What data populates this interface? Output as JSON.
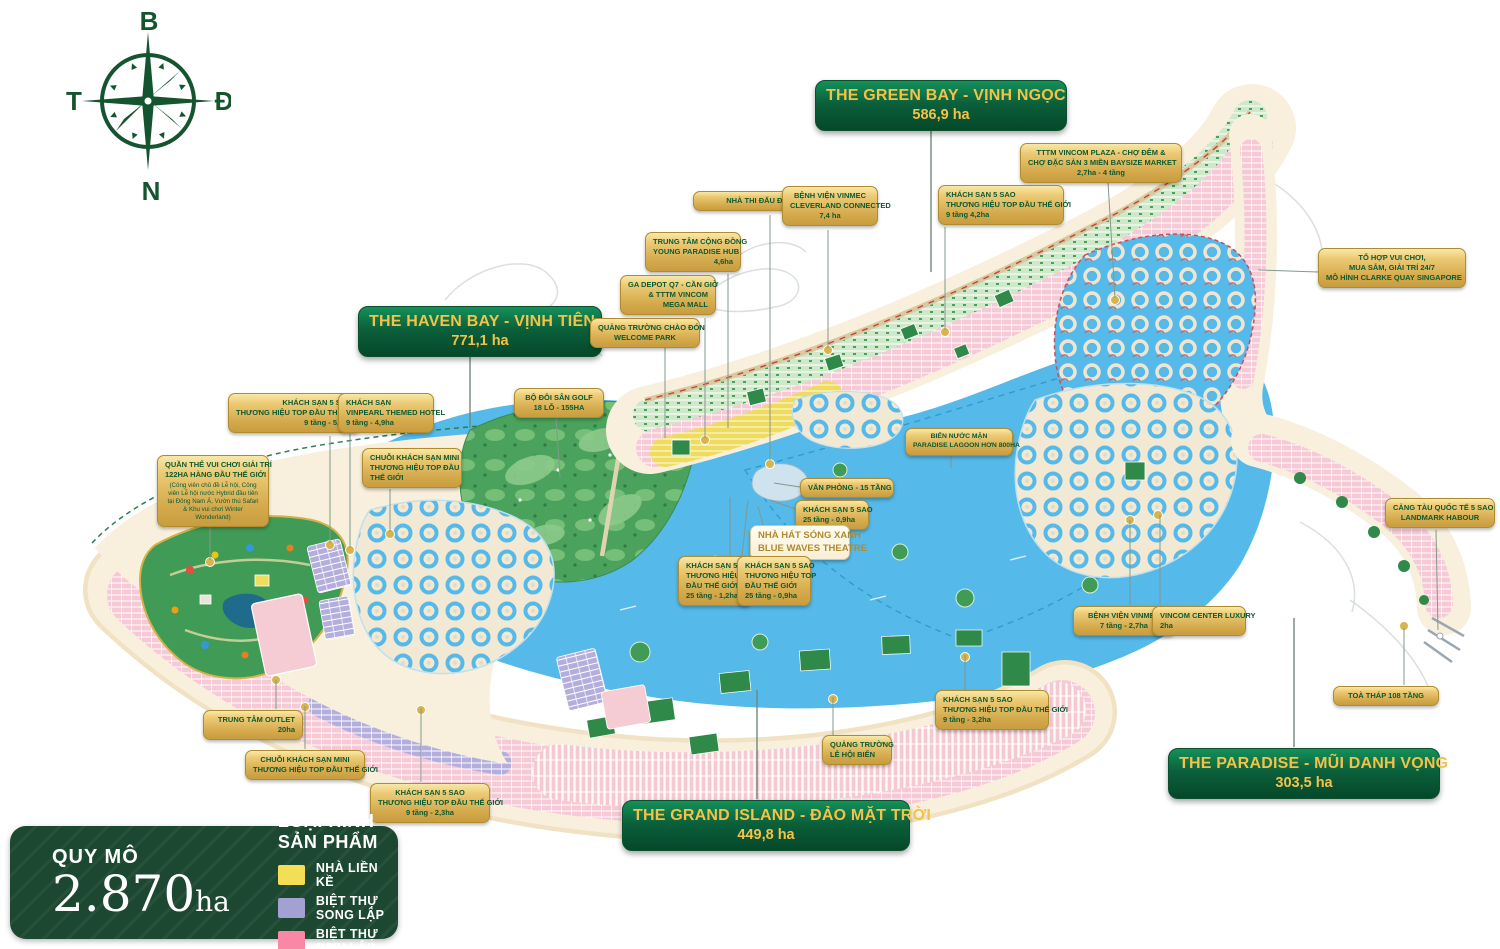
{
  "compass": {
    "north": "B",
    "east": "Đ",
    "south": "N",
    "west": "T",
    "color": "#14542f"
  },
  "zones": [
    {
      "id": "green-bay",
      "title": "THE GREEN BAY - VỊNH NGỌC",
      "area": "586,9 ha",
      "x": 815,
      "y": 80,
      "w": 230,
      "leader": [
        931,
        130,
        931,
        272
      ]
    },
    {
      "id": "haven-bay",
      "title": "THE HAVEN BAY - VỊNH TIÊN",
      "area": "771,1 ha",
      "x": 358,
      "y": 306,
      "w": 222,
      "leader": [
        470,
        355,
        470,
        428
      ]
    },
    {
      "id": "grand-island",
      "title": "THE GRAND ISLAND - ĐẢO MẶT TRỜI",
      "area": "449,8 ha",
      "x": 622,
      "y": 800,
      "w": 266,
      "leader": [
        757,
        799,
        757,
        690
      ]
    },
    {
      "id": "paradise",
      "title": "THE PARADISE - MŨI DANH VỌNG",
      "area": "303,5 ha",
      "x": 1168,
      "y": 748,
      "w": 250,
      "leader": [
        1294,
        747,
        1294,
        618
      ]
    }
  ],
  "callouts": [
    {
      "id": "tttm-vincom-plaza",
      "x": 1020,
      "y": 143,
      "w": 162,
      "align": "center",
      "lines": [
        "TTTM VINCOM PLAZA - CHỢ ĐÊM &",
        "CHỢ ĐẶC SẢN 3 MIỀN BAYSIZE MARKET",
        "2,7ha - 4 tầng"
      ],
      "leader": [
        1108,
        182,
        1115,
        298
      ]
    },
    {
      "id": "khach-san-4-2ha",
      "x": 938,
      "y": 185,
      "w": 126,
      "align": "left",
      "lines": [
        "KHÁCH SẠN 5 SAO",
        "THƯƠNG HIỆU TOP ĐẦU THẾ GIỚI",
        "9 tầng 4,2ha"
      ],
      "leader": [
        945,
        227,
        945,
        330
      ]
    },
    {
      "id": "nha-thi-dau",
      "x": 693,
      "y": 191,
      "w": 152,
      "align": "center",
      "lines": [
        "NHÀ THI ĐẤU ĐA NĂNG"
      ],
      "leader": [
        770,
        215,
        770,
        460
      ]
    },
    {
      "id": "benh-vien-cleverland",
      "x": 782,
      "y": 186,
      "w": 96,
      "align": "center",
      "lines": [
        "BỆNH VIỆN VINMEC",
        "CLEVERLAND CONNECTED",
        "7,4 ha"
      ],
      "leader": [
        828,
        230,
        828,
        348
      ]
    },
    {
      "id": "trung-tam-cong-dong",
      "x": 645,
      "y": 232,
      "w": 96,
      "align": "right",
      "lines": [
        "TRUNG TÂM CỘNG ĐỒNG",
        "YOUNG PARADISE HUB",
        "4,6ha"
      ],
      "leader": [
        728,
        274,
        728,
        428
      ]
    },
    {
      "id": "ga-depot",
      "x": 620,
      "y": 275,
      "w": 96,
      "align": "right",
      "lines": [
        "GA DEPOT Q7 - CẦN GIỜ",
        "& TTTM VINCOM",
        "MEGA MALL"
      ],
      "leader": [
        705,
        318,
        705,
        438
      ]
    },
    {
      "id": "quang-truong-chao-don",
      "x": 590,
      "y": 318,
      "w": 110,
      "align": "center",
      "lines": [
        "QUẢNG TRƯỜNG CHÀO ĐÓN",
        "WELCOME PARK"
      ],
      "leader": [
        665,
        348,
        665,
        438
      ]
    },
    {
      "id": "to-hop-vui-choi",
      "x": 1318,
      "y": 248,
      "w": 148,
      "align": "center",
      "lines": [
        "TỔ HỢP VUI CHƠI,",
        "MUA SẮM, GIẢI TRÍ 24/7",
        "MÔ HÌNH CLARKE QUAY SINGAPORE"
      ],
      "leader": [
        1318,
        272,
        1258,
        270
      ]
    },
    {
      "id": "khach-san-5-2ha",
      "x": 228,
      "y": 393,
      "w": 132,
      "align": "right",
      "lines": [
        "KHÁCH SẠN 5 SAO",
        "THƯƠNG HIỆU TOP ĐẦU THẾ GIỚI",
        "9 tầng - 5,2ha"
      ],
      "leader": [
        330,
        436,
        330,
        543
      ]
    },
    {
      "id": "vinpearl-hotel",
      "x": 338,
      "y": 393,
      "w": 96,
      "align": "left",
      "lines": [
        "KHÁCH SẠN",
        "VINPEARL THEMED HOTEL",
        "9 tầng - 4,9ha"
      ],
      "leader": [
        350,
        434,
        350,
        548
      ]
    },
    {
      "id": "bo-doi-san-golf",
      "x": 514,
      "y": 388,
      "w": 90,
      "align": "center",
      "lines": [
        "BỘ ĐÔI SÂN GOLF",
        "18 LỖ - 155HA"
      ],
      "leader": [
        556,
        418,
        560,
        478
      ]
    },
    {
      "id": "chuoi-khach-san-mini-1",
      "x": 362,
      "y": 448,
      "w": 100,
      "align": "left",
      "lines": [
        "CHUỖI KHÁCH SẠN MINI",
        "THƯƠNG HIỆU TOP ĐẦU",
        "THẾ GIỚI"
      ],
      "leader": [
        390,
        489,
        390,
        532
      ]
    },
    {
      "id": "quan-the-vui-choi",
      "x": 157,
      "y": 455,
      "w": 112,
      "align": "center",
      "lines": [
        "QUẦN THỂ VUI CHƠI GIẢI TRÍ",
        "122HA HÀNG ĐẦU  THẾ GIỚI"
      ],
      "small": "(Công viên chủ đề Lễ hội, Công viên Lễ hội nước Hybrid đầu tiên tại Đông Nam Á, Vườn thú Safari & Khu vui chơi Winter Wonderland)",
      "leader": [
        210,
        506,
        210,
        560
      ]
    },
    {
      "id": "bien-nuoc-man",
      "x": 905,
      "y": 428,
      "w": 108,
      "align": "center",
      "cls": "sm",
      "lines": [
        "BIỂN NƯỚC MẶN",
        "PARADISE LAGOON HƠN 800HA"
      ],
      "leader": [
        951,
        452,
        951,
        468
      ]
    },
    {
      "id": "van-phong",
      "x": 800,
      "y": 478,
      "w": 94,
      "align": "center",
      "lines": [
        "VĂN PHÒNG - 15 TẦNG"
      ],
      "leader": [
        800,
        487,
        774,
        483
      ]
    },
    {
      "id": "khach-san-0-9ha-a",
      "x": 795,
      "y": 500,
      "w": 74,
      "align": "left",
      "lines": [
        "KHÁCH SẠN 5 SAO",
        "25 tầng - 0,9ha"
      ],
      "leader": [
        795,
        509,
        770,
        500
      ]
    },
    {
      "id": "nha-hat-song-xanh",
      "x": 750,
      "y": 525,
      "w": 100,
      "align": "center",
      "variant": "light",
      "lines": [
        "NHÀ HÁT SÓNG XANH",
        "BLUE WAVES THEATRE"
      ],
      "leader": [
        763,
        525,
        758,
        506
      ]
    },
    {
      "id": "khach-san-1-2ha",
      "x": 678,
      "y": 556,
      "w": 74,
      "align": "left",
      "lines": [
        "KHÁCH SẠN 5 SAO",
        "THƯƠNG HIỆU TOP",
        "ĐẦU THẾ GIỚI",
        "25 tầng - 1,2ha"
      ],
      "leader": [
        730,
        556,
        730,
        497
      ]
    },
    {
      "id": "khach-san-0-9ha-b",
      "x": 737,
      "y": 556,
      "w": 74,
      "align": "left",
      "lines": [
        "KHÁCH SẠN 5 SAO",
        "THƯƠNG HIỆU TOP",
        "ĐẦU THẾ GIỚI",
        "25 tầng - 0,9ha"
      ],
      "leader": [
        742,
        556,
        748,
        500
      ]
    },
    {
      "id": "cang-tau-quoc-te",
      "x": 1385,
      "y": 498,
      "w": 110,
      "align": "center",
      "lines": [
        "CẢNG TÀU QUỐC TẾ 5 SAO",
        "LANDMARK HABOUR"
      ],
      "leader": [
        1436,
        530,
        1438,
        630
      ]
    },
    {
      "id": "benh-vien-vinmec",
      "x": 1073,
      "y": 606,
      "w": 102,
      "align": "center",
      "lines": [
        "BỆNH VIỆN VINMEC",
        "7 tầng - 2,7ha"
      ],
      "leader": [
        1130,
        605,
        1130,
        520
      ]
    },
    {
      "id": "vincom-center-luxury",
      "x": 1152,
      "y": 606,
      "w": 94,
      "align": "left",
      "lines": [
        "VINCOM CENTER LUXURY",
        "2ha"
      ],
      "leader": [
        1160,
        605,
        1160,
        515
      ]
    },
    {
      "id": "toa-thap-108",
      "x": 1333,
      "y": 686,
      "w": 106,
      "align": "center",
      "lines": [
        "TOÀ THÁP 108 TẦNG"
      ],
      "leader": [
        1404,
        685,
        1404,
        628
      ]
    },
    {
      "id": "khach-san-3-2ha",
      "x": 935,
      "y": 690,
      "w": 114,
      "align": "left",
      "lines": [
        "KHÁCH SẠN 5 SAO",
        "THƯƠNG HIỆU TOP ĐẦU THẾ GIỚI",
        "9 tầng - 3,2ha"
      ],
      "leader": [
        965,
        690,
        965,
        655
      ]
    },
    {
      "id": "quang-truong-le-hoi",
      "x": 822,
      "y": 735,
      "w": 70,
      "align": "left",
      "lines": [
        "QUẢNG TRƯỜNG",
        "LỄ HỘI BIỂN"
      ],
      "leader": [
        833,
        735,
        833,
        697
      ]
    },
    {
      "id": "trung-tam-outlet",
      "x": 203,
      "y": 710,
      "w": 100,
      "align": "right",
      "lines": [
        "TRUNG TÂM OUTLET",
        "20ha"
      ],
      "leader": [
        276,
        709,
        276,
        680
      ]
    },
    {
      "id": "chuoi-khach-san-mini-2",
      "x": 245,
      "y": 750,
      "w": 120,
      "align": "center",
      "lines": [
        "CHUỖI KHÁCH SẠN MINI",
        "THƯƠNG HIỆU TOP ĐẦU THẾ GIỚI"
      ],
      "leader": [
        305,
        749,
        305,
        706
      ]
    },
    {
      "id": "khach-san-2-3ha",
      "x": 370,
      "y": 783,
      "w": 120,
      "align": "center",
      "lines": [
        "KHÁCH SẠN 5 SAO",
        "THƯƠNG HIỆU TOP ĐẦU THẾ GIỚI",
        "9 tầng - 2,3ha"
      ],
      "leader": [
        421,
        782,
        421,
        708
      ]
    }
  ],
  "legend": {
    "scale_label": "QUY MÔ",
    "scale_value": "2.870",
    "scale_unit": "ha",
    "types_title": "LOẠI HÌNH SẢN PHẨM",
    "items": [
      {
        "label": "NHÀ LIỀN KỀ",
        "color": "#f2df55"
      },
      {
        "label": "BIỆT THỰ SONG LẬP",
        "color": "#a3a0d4"
      },
      {
        "label": "BIỆT THỰ ĐƠN LẬP",
        "color": "#f888a6"
      }
    ]
  },
  "map_colors": {
    "water": "#55b9e9",
    "land": "#f8f0dd",
    "park_green": "#2f8a4a",
    "gold": "#d5ab4e",
    "banner_green": "#0b603a"
  }
}
